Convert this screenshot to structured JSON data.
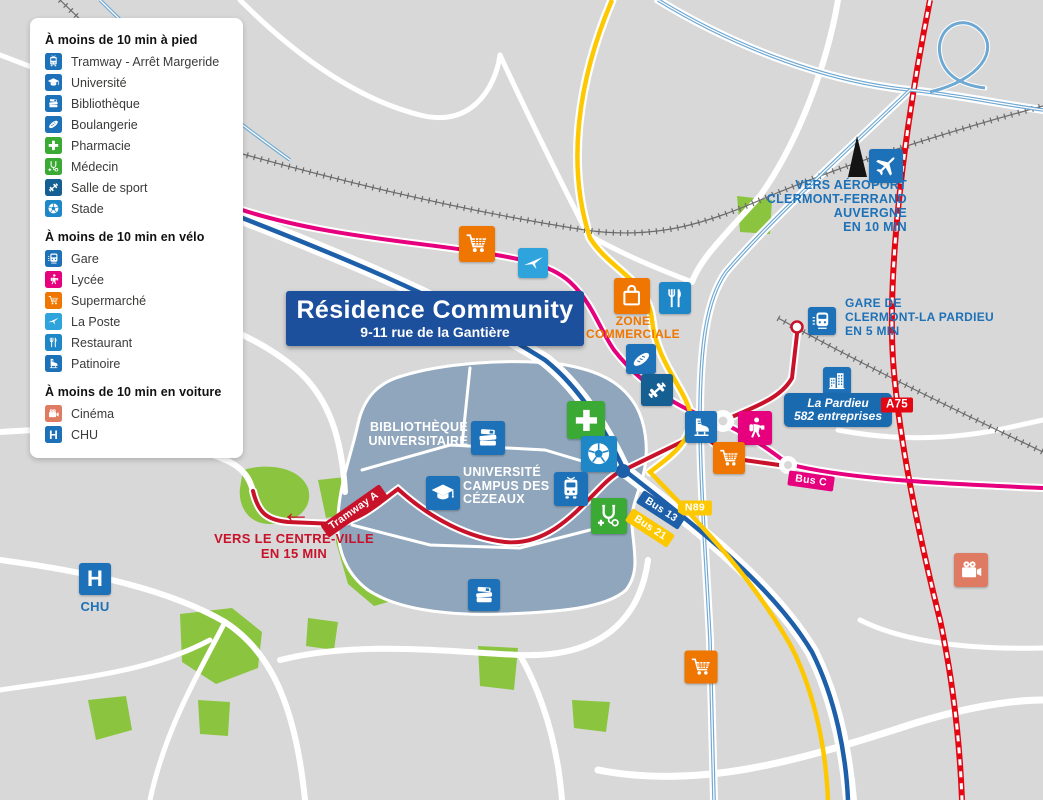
{
  "palette": {
    "map_background": "#d8d8d8",
    "road_white": "#ffffff",
    "park_green": "#8bc53f",
    "campus_bluegray": "#8fa6bc",
    "brand_navy": "#1c4f9c",
    "icon_blue": "#1d71b8",
    "icon_light_blue": "#2fa3dc",
    "icon_mid_blue": "#1e87c8",
    "icon_dark_blue": "#165f93",
    "icon_green": "#3aaa35",
    "icon_orange": "#ee7601",
    "icon_pink": "#e6007e",
    "icon_salmon": "#e07b63",
    "line_red": "#c8122a",
    "line_yellow": "#fdc800",
    "line_pink": "#e6007e",
    "line_blue": "#1d5fa8",
    "line_light_blue": "#6fa8d2",
    "a75_red": "#e30613"
  },
  "legend": {
    "sections": [
      {
        "title": "À moins de 10 min à pied",
        "items": [
          {
            "icon": "tram-icon",
            "label": "Tramway - Arrêt Margeride"
          },
          {
            "icon": "graduation-cap-icon",
            "label": "Université"
          },
          {
            "icon": "books-icon",
            "label": "Bibliothèque"
          },
          {
            "icon": "baguette-icon",
            "label": "Boulangerie"
          },
          {
            "icon": "cross-icon",
            "label": "Pharmacie"
          },
          {
            "icon": "stethoscope-icon",
            "label": "Médecin"
          },
          {
            "icon": "dumbbell-icon",
            "label": "Salle de sport"
          },
          {
            "icon": "soccer-ball-icon",
            "label": "Stade"
          }
        ]
      },
      {
        "title": "À moins de 10 min en vélo",
        "items": [
          {
            "icon": "train-icon",
            "label": "Gare"
          },
          {
            "icon": "student-icon",
            "label": "Lycée"
          },
          {
            "icon": "cart-icon",
            "label": "Supermarché"
          },
          {
            "icon": "bird-icon",
            "label": "La Poste"
          },
          {
            "icon": "fork-knife-icon",
            "label": "Restaurant"
          },
          {
            "icon": "ice-skate-icon",
            "label": "Patinoire"
          }
        ]
      },
      {
        "title": "À moins de 10 min en voiture",
        "items": [
          {
            "icon": "film-camera-icon",
            "label": "Cinéma"
          },
          {
            "icon": "hospital-h-icon",
            "label": "CHU"
          }
        ]
      }
    ]
  },
  "banner": {
    "title": "Résidence Community",
    "subtitle": "9-11 rue de la Gantière"
  },
  "map": {
    "airport_label": "VERS AÉROPORT\nCLERMONT-FERRAND\nAUVERGNE\nEN 10 MIN",
    "station_label": "GARE DE\nCLERMONT-LA PARDIEU\nEN 5 MIN",
    "zone_label": "ZONE\nCOMMERCIALE",
    "library_label": "BIBLIOTHÈQUE\nUNIVERSITAIRE",
    "university_label": "UNIVERSITÉ\nCAMPUS DES\nCÉZEAUX",
    "center_city_label": "VERS LE CENTRE-VILLE\nEN 15 MIN",
    "arrow": "←",
    "chu_label": "CHU",
    "hospital_letter": "H",
    "pardieu_badge": {
      "line1": "La Pardieu",
      "line2": "582 entreprises"
    },
    "road_badges": {
      "a75": "A75",
      "n89": "N89",
      "bus13": "Bus 13",
      "bus21": "Bus 21",
      "bus_c": "Bus C",
      "tramway_a": "Tramway A"
    }
  },
  "icon_shapes": {
    "tram-icon": "tram front view",
    "graduation-cap-icon": "mortarboard",
    "books-icon": "stack of books",
    "baguette-icon": "bread baguette",
    "cross-icon": "pharmacy cross",
    "stethoscope-icon": "stethoscope with small cross",
    "dumbbell-icon": "dumbbell",
    "soccer-ball-icon": "soccer ball",
    "train-icon": "train front view",
    "student-icon": "walking student with backpack",
    "cart-icon": "shopping cart",
    "bird-icon": "la poste swallow",
    "fork-knife-icon": "fork and knife",
    "ice-skate-icon": "ice skate",
    "film-camera-icon": "movie camera",
    "hospital-h-icon": "letter H",
    "buildings-icon": "office buildings",
    "shopping-bag-icon": "shopping bag",
    "plane-icon": "airplane"
  }
}
